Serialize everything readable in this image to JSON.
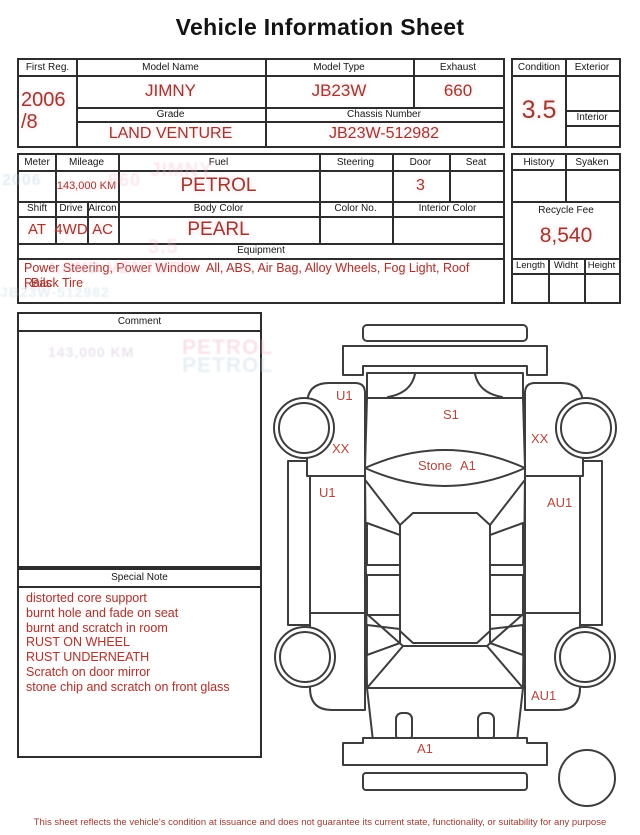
{
  "title": "Vehicle Information Sheet",
  "accent": "#9c392f",
  "reg_box": {
    "first_reg_label": "First Reg.",
    "first_reg_year": "2006",
    "first_reg_month": "/8",
    "model_name_label": "Model Name",
    "model_name": "JIMNY",
    "model_type_label": "Model Type",
    "model_type": "JB23W",
    "exhaust_label": "Exhaust",
    "exhaust": "660",
    "grade_label": "Grade",
    "grade": "LAND VENTURE",
    "chassis_label": "Chassis Number",
    "chassis": "JB23W-512982"
  },
  "condition_box": {
    "condition_label": "Condition",
    "condition": "3.5",
    "exterior_label": "Exterior",
    "exterior": "",
    "interior_label": "Interior",
    "interior": ""
  },
  "spec_box": {
    "meter_label": "Meter",
    "meter": "",
    "mileage_label": "Mileage",
    "mileage": "143,000 KM",
    "fuel_label": "Fuel",
    "fuel": "PETROL",
    "steering_label": "Steering",
    "steering": "",
    "door_label": "Door",
    "door": "3",
    "seat_label": "Seat",
    "seat": "",
    "shift_label": "Shift",
    "shift": "AT",
    "drive_label": "Drive",
    "drive": "4WD",
    "aircon_label": "Aircon",
    "aircon": "AC",
    "body_color_label": "Body Color",
    "body_color": "PEARL",
    "color_no_label": "Color No.",
    "color_no": "",
    "interior_color_label": "Interior Color",
    "interior_color": "",
    "equipment_label": "Equipment",
    "equipment_line1": "Power Steering, Power Window  All, ABS, Air Bag, Alloy Wheels, Fog Light, Roof Rails",
    "equipment_line2": ", Back Tire"
  },
  "fee_box": {
    "history_label": "History",
    "history": "",
    "syaken_label": "Syaken",
    "syaken": "",
    "recycle_label": "Recycle Fee",
    "recycle_fee": "8,540",
    "length_label": "Length",
    "length": "",
    "width_label": "Widht",
    "width": "",
    "height_label": "Height",
    "height": ""
  },
  "comment_box": {
    "label": "Comment"
  },
  "special_note": {
    "label": "Special Note",
    "lines": [
      "distorted core support",
      "burnt hole and fade on seat",
      "burnt and scratch in room",
      "RUST ON WHEEL",
      "RUST UNDERNEATH",
      "Scratch on door mirror",
      "stone chip and scratch on front glass"
    ]
  },
  "diagram": {
    "annotations": [
      {
        "text": "U1",
        "x": 66,
        "y": 87
      },
      {
        "text": "S1",
        "x": 173,
        "y": 106
      },
      {
        "text": "XX",
        "x": 62,
        "y": 140
      },
      {
        "text": "XX",
        "x": 261,
        "y": 130
      },
      {
        "text": "Stone",
        "x": 148,
        "y": 157
      },
      {
        "text": "A1",
        "x": 190,
        "y": 157
      },
      {
        "text": "U1",
        "x": 49,
        "y": 184
      },
      {
        "text": "AU1",
        "x": 277,
        "y": 194
      },
      {
        "text": "AU1",
        "x": 261,
        "y": 387
      },
      {
        "text": "A1",
        "x": 147,
        "y": 440
      }
    ]
  },
  "scan_ghosts": [
    {
      "text": "PETROL",
      "x": 182,
      "y": 336,
      "size": 21,
      "color": "#f0a9c0"
    },
    {
      "text": "PETROL",
      "x": 182,
      "y": 354,
      "size": 21,
      "color": "#b9d2e0"
    },
    {
      "text": "143,000 KM",
      "x": 48,
      "y": 344,
      "size": 14,
      "color": "#c3aed0"
    },
    {
      "text": "JIMNY",
      "x": 150,
      "y": 160,
      "size": 19,
      "color": "#f6b8ca"
    },
    {
      "text": "660",
      "x": 108,
      "y": 170,
      "size": 18,
      "color": "#f6b8ca"
    },
    {
      "text": "2006",
      "x": 2,
      "y": 172,
      "size": 16,
      "color": "#a9c8da"
    },
    {
      "text": "3.5",
      "x": 148,
      "y": 236,
      "size": 20,
      "color": "#f6b8ca"
    },
    {
      "text": "LAND VENTURE",
      "x": 50,
      "y": 258,
      "size": 17,
      "color": "#f6b8ca"
    },
    {
      "text": "JB23W-512982",
      "x": 0,
      "y": 284,
      "size": 14,
      "color": "#b9d2e0"
    }
  ],
  "footer": "This sheet reflects the vehicle's condition at issuance and does not guarantee its current state, functionality, or suitability for any purpose"
}
